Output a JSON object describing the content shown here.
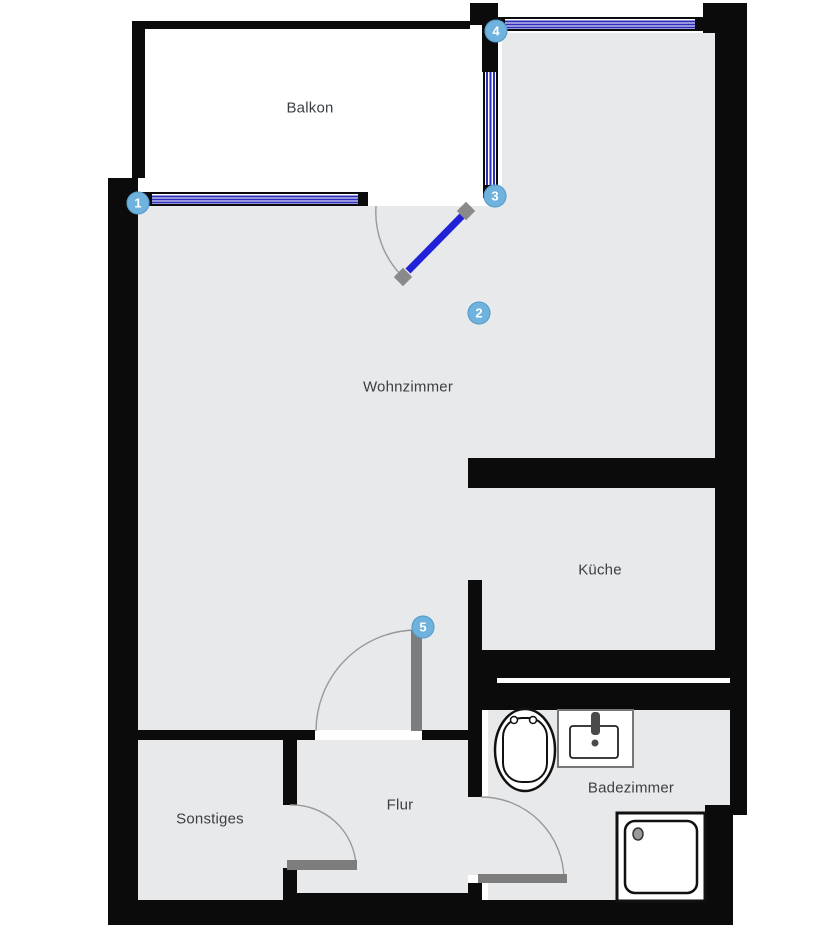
{
  "rooms": {
    "balkon": {
      "label": "Balkon"
    },
    "wohnzimmer": {
      "label": "Wohnzimmer"
    },
    "kueche": {
      "label": "Küche"
    },
    "flur": {
      "label": "Flur"
    },
    "sonstiges": {
      "label": "Sonstiges"
    },
    "badezimmer": {
      "label": "Badezimmer"
    }
  },
  "markers": [
    {
      "number": "1"
    },
    {
      "number": "2"
    },
    {
      "number": "3"
    },
    {
      "number": "4"
    },
    {
      "number": "5"
    }
  ],
  "colors": {
    "wall": "#0b0b0b",
    "floor": "#e8e9eb",
    "window_blue": "#2d2dbb",
    "door_blue": "#2122d8",
    "interior_door_gray": "#7d7d7d",
    "marker_blue": "#6fb2de",
    "label_text": "#3c4043"
  }
}
